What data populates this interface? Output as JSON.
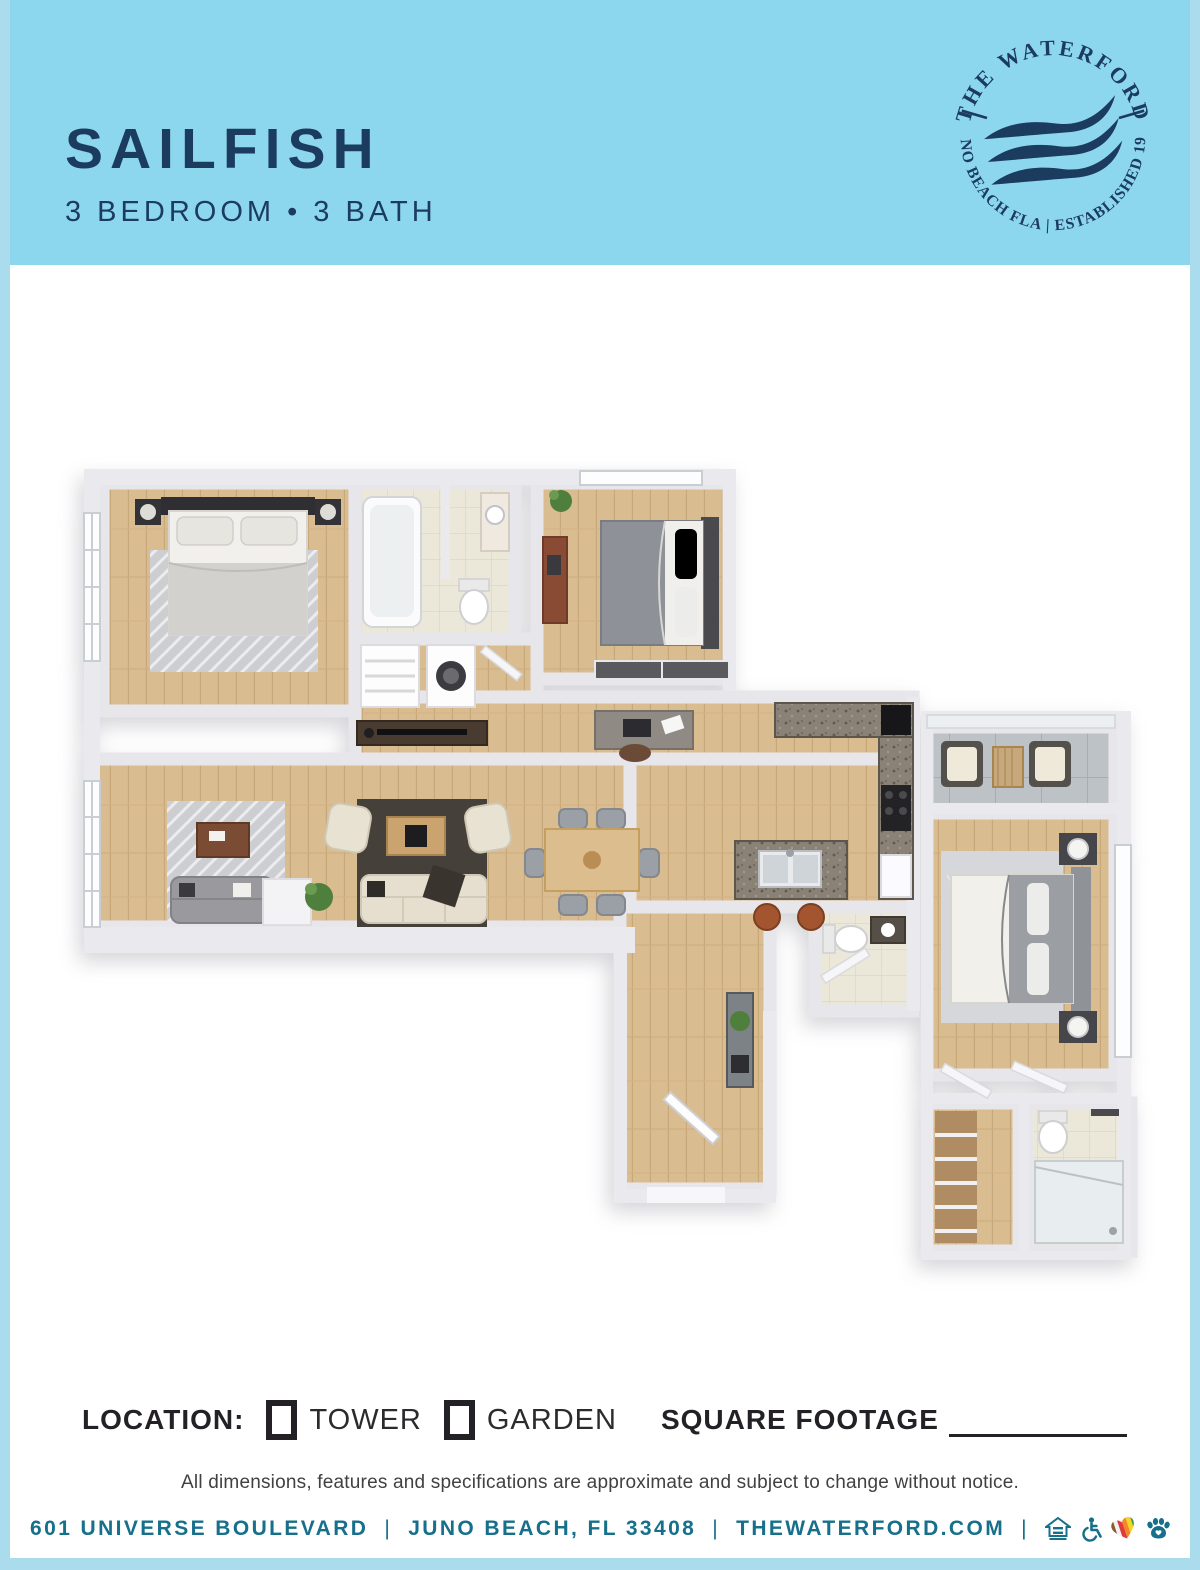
{
  "theme": {
    "header-bg": "#8dd7ee",
    "frame": "#abdcee",
    "navy": "#1b3b5f",
    "footer": "#17708b",
    "ink": "#232126",
    "wood": "#d9bc90",
    "tile": "#ebe7d9",
    "balcony": "#bcc2c6"
  },
  "header": {
    "title": "SAILFISH",
    "subtitle": "3 BEDROOM • 3 BATH"
  },
  "logo": {
    "top_text": "THE WATERFORD",
    "bottom_text": "JUNO BEACH FLA  |  ESTABLISHED 1982",
    "color": "#1b3b5f",
    "emblem": "waves-icon"
  },
  "location": {
    "label": "LOCATION:",
    "options": [
      {
        "label": "TOWER"
      },
      {
        "label": "GARDEN"
      }
    ],
    "sqft_label": "SQUARE FOOTAGE"
  },
  "disclaimer": {
    "text": "All dimensions, features and specifications are approximate and subject to change without notice."
  },
  "footer": {
    "address": "601 UNIVERSE BOULEVARD",
    "city": "JUNO BEACH, FL 33408",
    "website": "THEWATERFORD.COM",
    "separator": "|",
    "icons": [
      "equal-housing-icon",
      "accessibility-icon",
      "pride-heart-icon",
      "paw-icon"
    ]
  }
}
